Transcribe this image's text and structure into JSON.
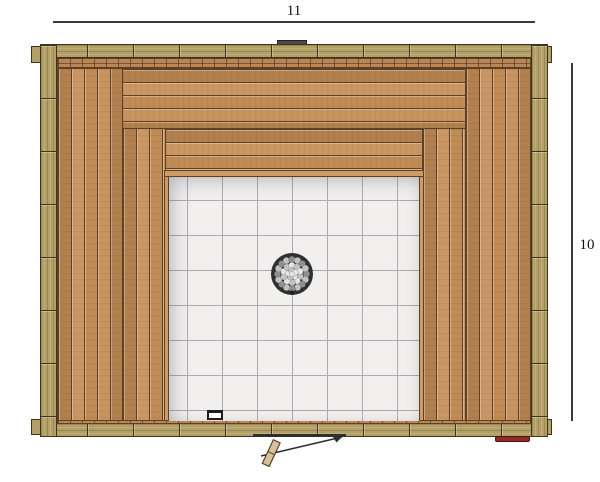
{
  "drawing": {
    "type": "sauna floor plan, top view",
    "dimensions": {
      "top_label": "11",
      "right_label": "10"
    }
  },
  "colors": {
    "wall": "#b2a066",
    "wall-line": "#3f331d",
    "wood": "#c68f58",
    "wood-line": "#5e4124",
    "wood-light-strip": "#cf9a63",
    "rail": "#bb8656",
    "tile": "#f1f0ee",
    "tile-line": "#abaab2",
    "dim": "#3a3a3a",
    "stove-ring": "#2f2f2f",
    "stone-light": "#e4e4e4",
    "stone-mid": "#c2c2c2",
    "stone-dark": "#8f8f8f",
    "red-accent": "#8f2b26"
  },
  "stove": {
    "stones_outer": 16,
    "stones_inner": 10,
    "stones_core": 5
  }
}
